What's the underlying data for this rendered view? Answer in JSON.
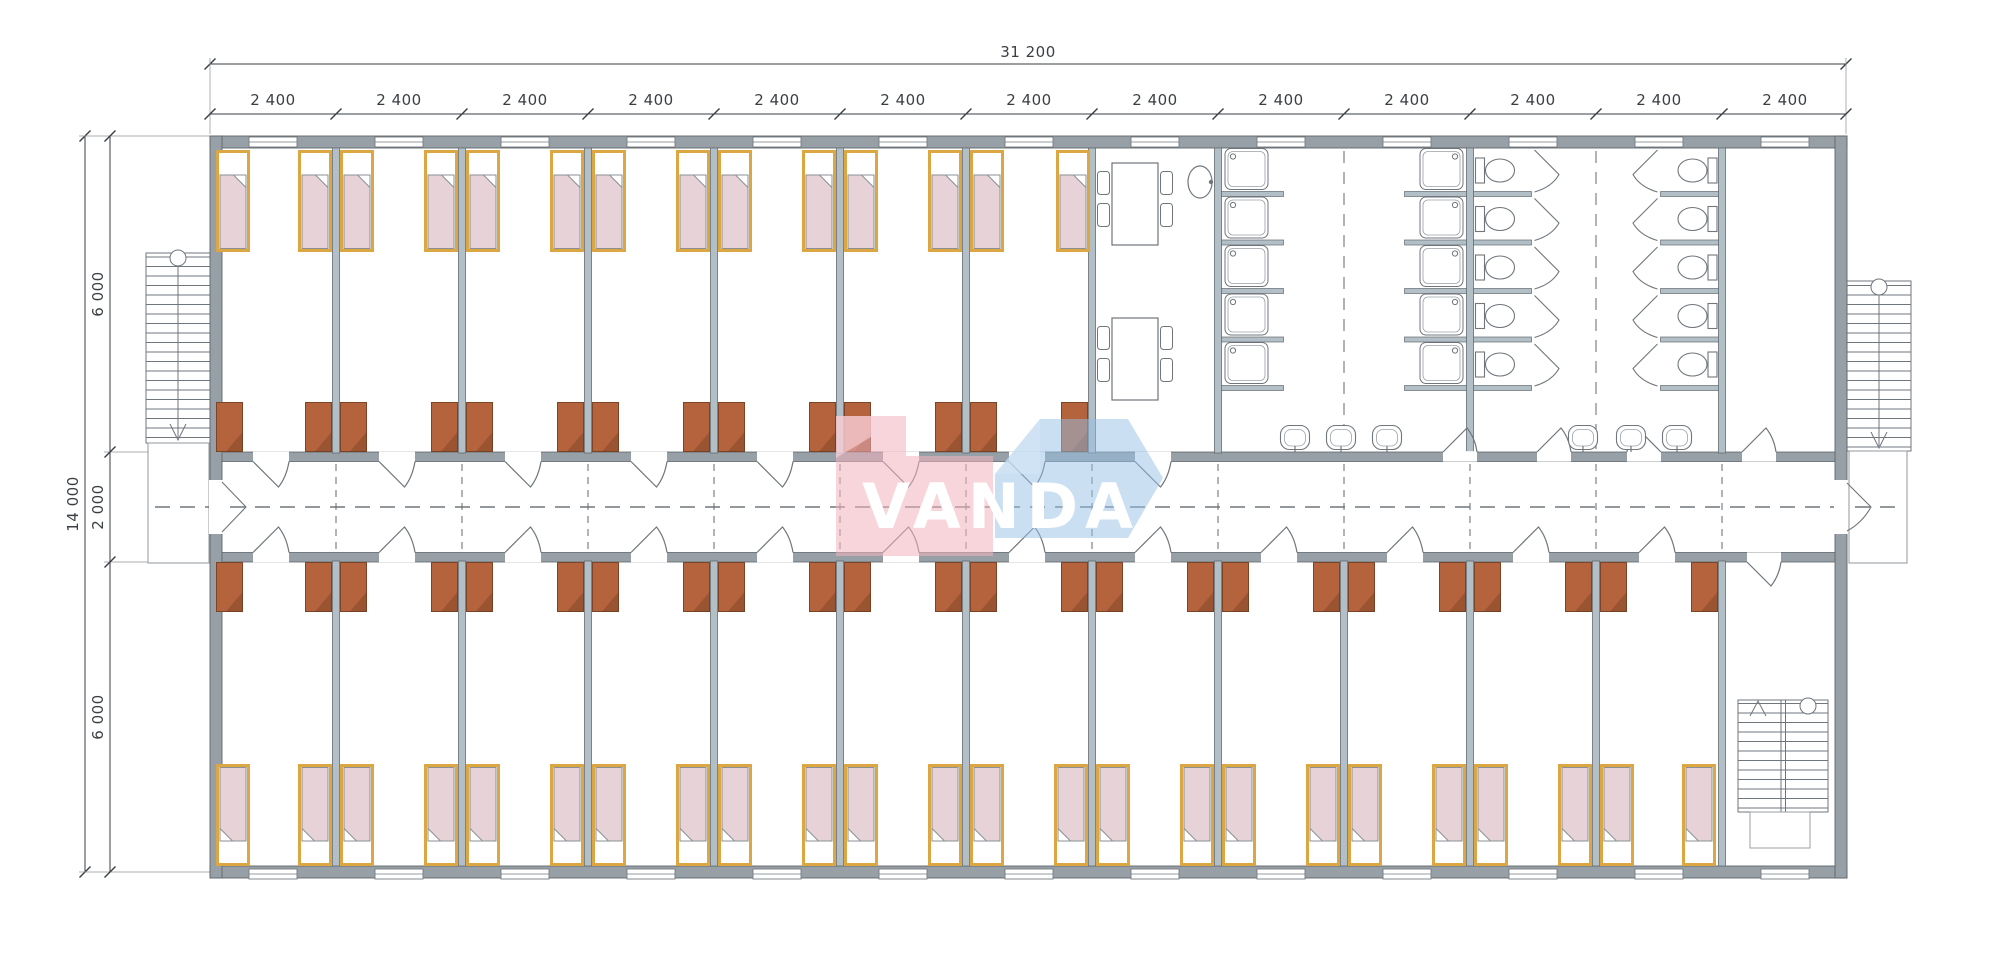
{
  "drawing": {
    "logo_text": "VANDA"
  },
  "dimensions": {
    "overall_width": "31 200",
    "module": "2 400",
    "overall_depth": "14 000",
    "top_room_depth": "6 000",
    "corridor_width": "2 000",
    "bottom_room_depth": "6 000"
  },
  "colors": {
    "exterior_wall": "#97a0a6",
    "partition_wall": "#b3bfc6",
    "bed_frame": "#dca743",
    "bed_blanket": "#e7d2d8",
    "wardrobe": "#b4633c",
    "plan_line": "#6f767c",
    "logo_pink": "#f2b2be",
    "logo_blue": "#96c0e6"
  },
  "inventory": {
    "modules": 13,
    "bedrooms_top_row": 7,
    "bedrooms_bottom_row": 12,
    "beds": 38,
    "wardrobes": 38,
    "dining_tables": 2,
    "shower_stalls": 10,
    "toilet_stalls": 10,
    "wash_basins": 6,
    "sinks": 1,
    "exterior_stairs": 2,
    "interior_stairs": 1
  }
}
